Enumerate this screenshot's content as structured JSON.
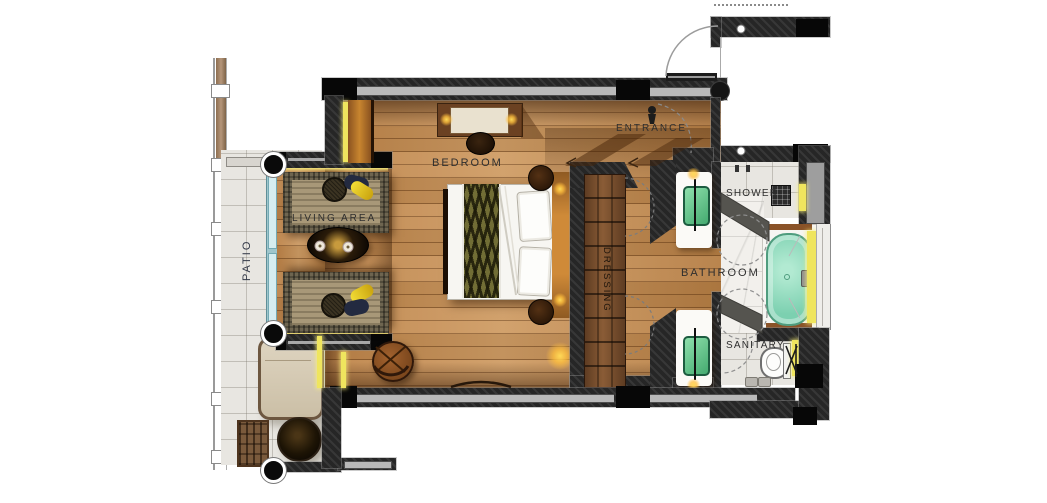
{
  "plan": {
    "title": "hotel-suite-floor-plan",
    "rooms": {
      "patio": {
        "label": "PATIO"
      },
      "living_area": {
        "label": "LIVING AREA"
      },
      "bedroom": {
        "label": "BEDROOM"
      },
      "entrance": {
        "label": "ENTRANCE"
      },
      "dressing": {
        "label": "DRESSING"
      },
      "bathroom": {
        "label": "BATHROOM"
      },
      "shower": {
        "label": "SHOWER"
      },
      "sanitary": {
        "label": "SANITARY"
      }
    },
    "furniture": [
      "double-bed",
      "headboard",
      "nightstands",
      "desk",
      "stool",
      "wardrobe",
      "sofa-top",
      "sofa-bottom",
      "oval-coffee-table",
      "chaise-lounge",
      "round-patio-table",
      "slat-chair",
      "barrel-armchair",
      "bathtub",
      "toilet",
      "shower-head",
      "vanity-sink-top",
      "vanity-sink-bottom",
      "sliding-glass-door",
      "entrance-door"
    ],
    "colors": {
      "wall_dark": "#262626",
      "wall_black": "#070707",
      "glazing_gray": "#b9b9b9",
      "wood_floor": "#c28a52",
      "patio_tile": "#e8e6e1",
      "marble": "#f2f0ec",
      "tub_teal": "#7cd0b0",
      "sink_green": "#59c184",
      "accent_yellow": "#efe55e",
      "lamp_glow": "#ffd957",
      "label_text": "#2e2e2e"
    }
  }
}
